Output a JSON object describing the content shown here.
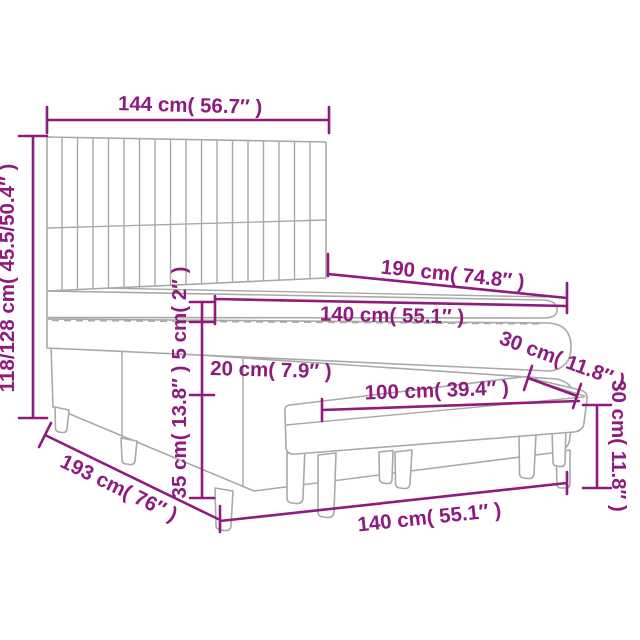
{
  "diagram": {
    "product": "Box spring bed with slatted headboard, topper and bench",
    "background_color": "#ffffff",
    "dimension_color": "#8e1b7d",
    "outline_color": "#a9a9a9",
    "labels": {
      "headboard_width": "144 cm( 56.7″ )",
      "height_range": "118/128 cm( 45.5/50.4″ )",
      "bed_length": "190 cm( 74.8″ )",
      "mattress_width": "140 cm( 55.1″ )",
      "topper_thickness": "5 cm( 2″ )",
      "mattress_thickness": "20 cm( 7.9″ )",
      "bench_depth": "30 cm( 11.8″ )",
      "bench_length": "100 cm( 39.4″ )",
      "bench_height": "30 cm( 11.8″ )",
      "base_height": "35 cm( 13.8″ )",
      "total_length": "193 cm( 76″ )",
      "bed_width": "140 cm( 55.1″ )"
    }
  }
}
